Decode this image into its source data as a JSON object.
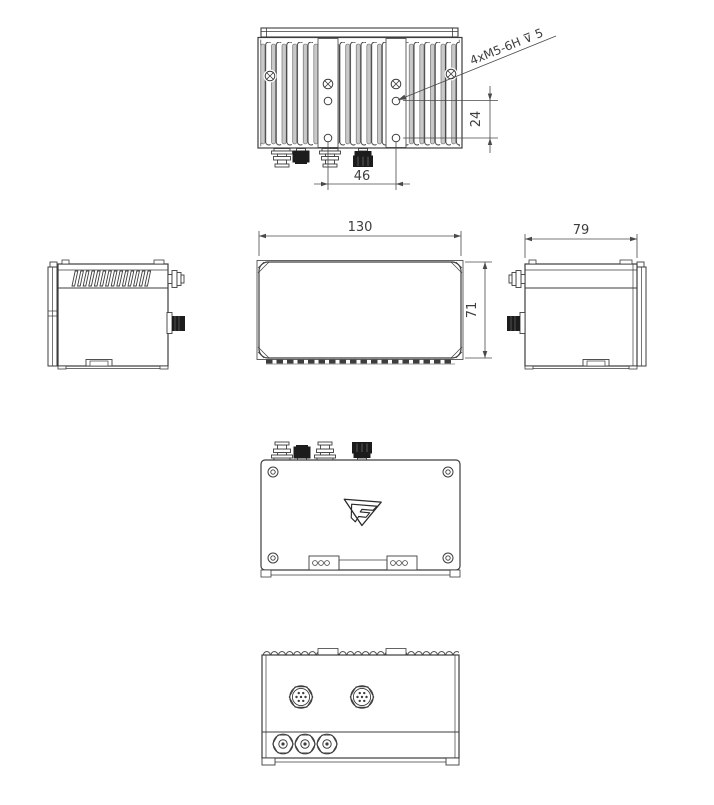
{
  "sheet": {
    "background": "#ffffff",
    "line_color": "#3d3d3d",
    "fin_gray": "#c9c9c9",
    "connector_black": "#1c1c1c"
  },
  "dimensions": {
    "overall_width": "130",
    "overall_depth": "79",
    "overall_height": "71",
    "hole_spacing_horizontal": "46",
    "hole_offset_vertical": "24"
  },
  "callout": {
    "thread_note": "4xM5-6H ⊽ 5"
  }
}
